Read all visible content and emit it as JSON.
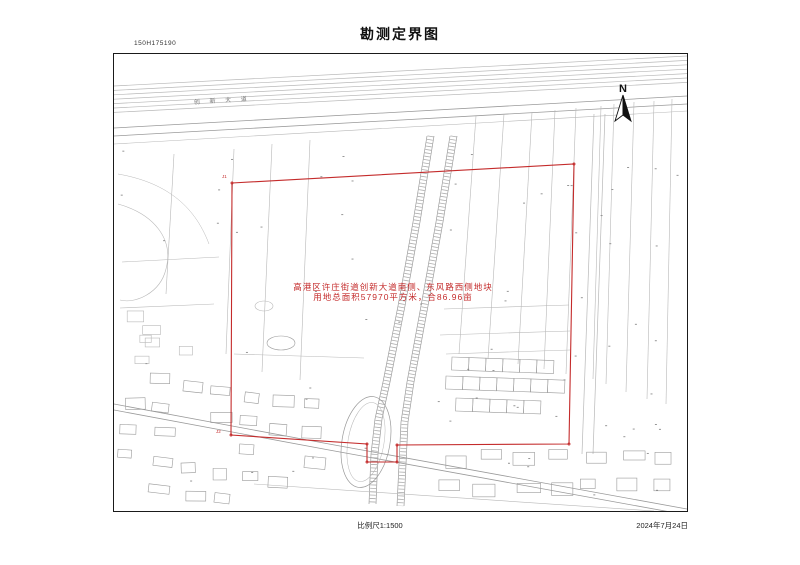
{
  "document": {
    "number": "150H175190",
    "title": "勘测定界图",
    "footer": {
      "scale": "比例尺1:1500",
      "date": "2024年7月24日"
    }
  },
  "map": {
    "north_label": "N",
    "road_label": "创 新 大 道",
    "annotation": {
      "line1": "高港区许庄街道创新大道南侧、东风路西侧地块",
      "line2": "用地总面积57970平方米，合86.96亩"
    },
    "boundary_points": [
      "J1",
      "J2"
    ],
    "colors": {
      "boundary": "#c42b2b",
      "linework": "#a8a8a8"
    }
  }
}
